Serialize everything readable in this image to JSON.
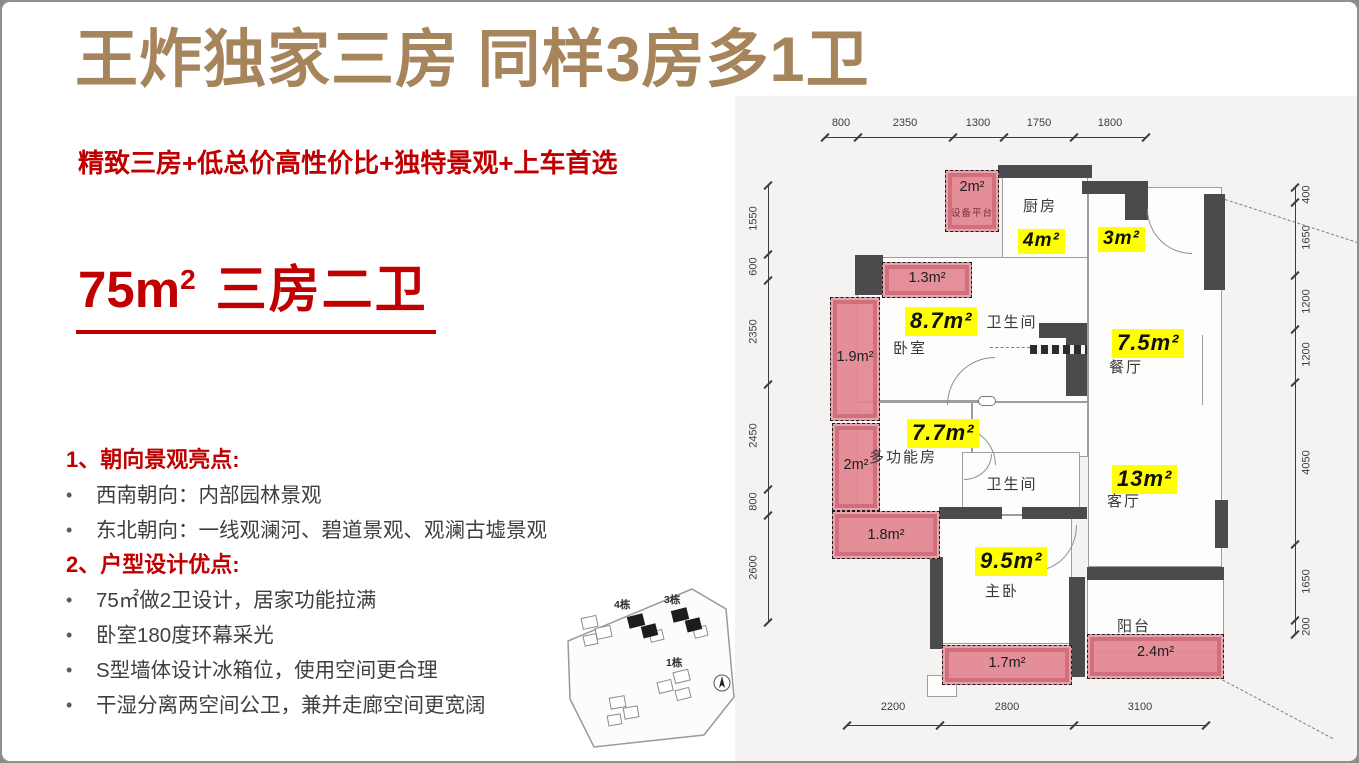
{
  "slide": {
    "title": "王炸独家三房 同样3房多1卫",
    "subtitle": "精致三房+低总价高性价比+独特景观+上车首选",
    "headline": {
      "area": "75m",
      "sup": "2",
      "type": "三房二卫"
    },
    "bullet_char": "•",
    "sections": [
      {
        "heading": "1、朝向景观亮点:",
        "bullets": [
          "西南朝向：内部园林景观",
          "东北朝向：一线观澜河、碧道景观、观澜古墟景观"
        ]
      },
      {
        "heading": "2、户型设计优点:",
        "bullets": [
          "75㎡做2卫设计，居家功能拉满",
          "卧室180度环幕采光",
          "S型墙体设计冰箱位，使用空间更合理",
          "干湿分离两空间公卫，兼并走廊空间更宽阔"
        ]
      }
    ]
  },
  "siteplan": {
    "buildings": [
      "4栋",
      "3栋",
      "1栋"
    ],
    "compass": "north-arrow"
  },
  "floorplan": {
    "dims": {
      "top": [
        "800",
        "2350",
        "1300",
        "1750",
        "1800"
      ],
      "left": [
        "1550",
        "600",
        "2350",
        "2450",
        "800",
        "2600"
      ],
      "right": [
        "400",
        "1650",
        "1200",
        "1200",
        "4050",
        "1650",
        "200"
      ],
      "bottom": [
        "2200",
        "2800",
        "3100"
      ]
    },
    "rooms": {
      "equip": {
        "name": "设备平台",
        "area": "2m²"
      },
      "kitchen": {
        "name": "厨房",
        "area": "4m²"
      },
      "entry": {
        "area": "3m²"
      },
      "bedroom": {
        "name": "卧室",
        "area": "8.7m²"
      },
      "bath1": {
        "name": "卫生间"
      },
      "dining": {
        "name": "餐厅",
        "area": "7.5m²"
      },
      "multi": {
        "name": "多功能房",
        "area": "7.7m²"
      },
      "bath2": {
        "name": "卫生间"
      },
      "living": {
        "name": "客厅",
        "area": "13m²"
      },
      "master": {
        "name": "主卧",
        "area": "9.5m²"
      },
      "balcony": {
        "name": "阳台",
        "area": "2.4m²"
      }
    },
    "bays": {
      "b13": "1.3m²",
      "b19": "1.9m²",
      "b2": "2m²",
      "b18": "1.8m²",
      "b17": "1.7m²"
    }
  },
  "colors": {
    "accent_brown": "#a6845c",
    "accent_red": "#c00000",
    "highlight_yellow": "#ffff00",
    "bay_pink": "#e28591",
    "wall_gray": "#4b4b4e"
  }
}
